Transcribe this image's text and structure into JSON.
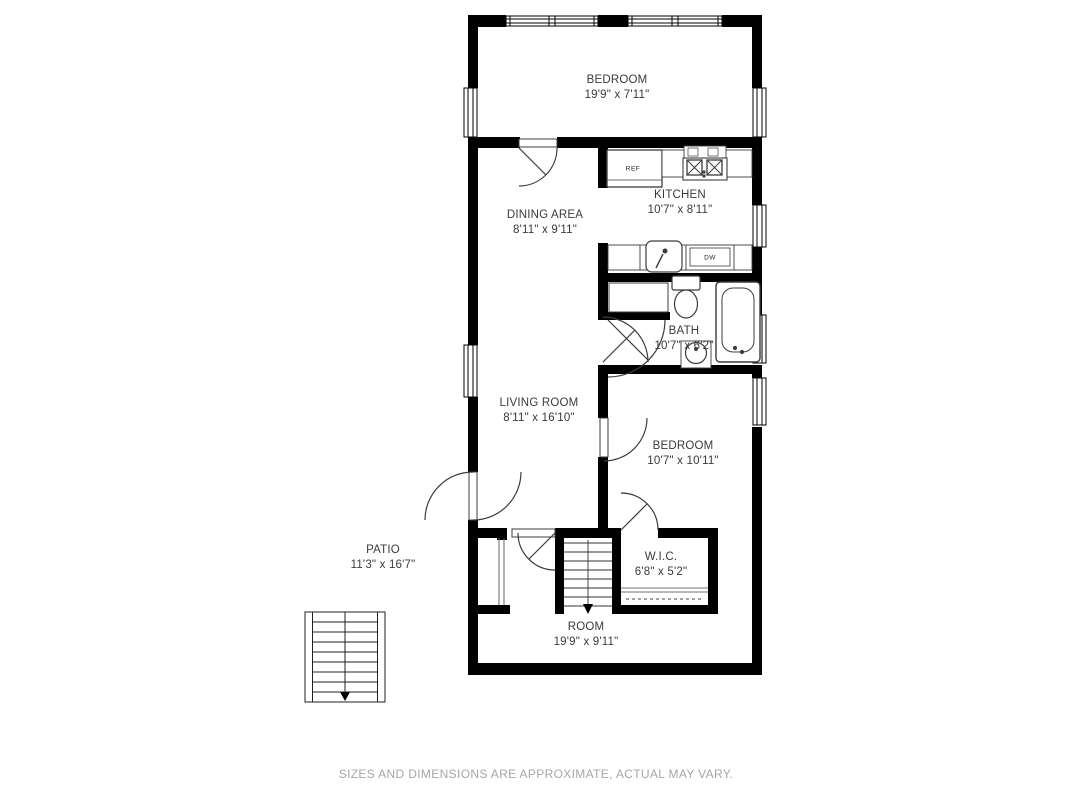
{
  "title": "Floor plan",
  "rooms": [
    {
      "id": "bedroom-top",
      "name": "BEDROOM",
      "dims": "19'9\" x 7'11\""
    },
    {
      "id": "dining",
      "name": "DINING AREA",
      "dims": "8'11\" x 9'11\""
    },
    {
      "id": "kitchen",
      "name": "KITCHEN",
      "dims": "10'7\" x 8'11\""
    },
    {
      "id": "bath",
      "name": "BATH",
      "dims": "10'7\" x 6'2\""
    },
    {
      "id": "living",
      "name": "LIVING ROOM",
      "dims": "8'11\" x 16'10\""
    },
    {
      "id": "bedroom-2",
      "name": "BEDROOM",
      "dims": "10'7\" x 10'11\""
    },
    {
      "id": "patio",
      "name": "PATIO",
      "dims": "11'3\" x 16'7\""
    },
    {
      "id": "wic",
      "name": "W.I.C.",
      "dims": "6'8\" x 5'2\""
    },
    {
      "id": "room",
      "name": "ROOM",
      "dims": "19'9\" x 9'11\""
    }
  ],
  "fixtures": {
    "ref": "REF",
    "dw": "DW"
  },
  "footer": {
    "disclaimer": "SIZES AND DIMENSIONS ARE APPROXIMATE, ACTUAL MAY VARY."
  },
  "colors": {
    "wall": "#000000",
    "label": "#3a3a3a",
    "disclaimer": "#a6a6a6",
    "fixture_stroke": "#3c3c3c"
  }
}
